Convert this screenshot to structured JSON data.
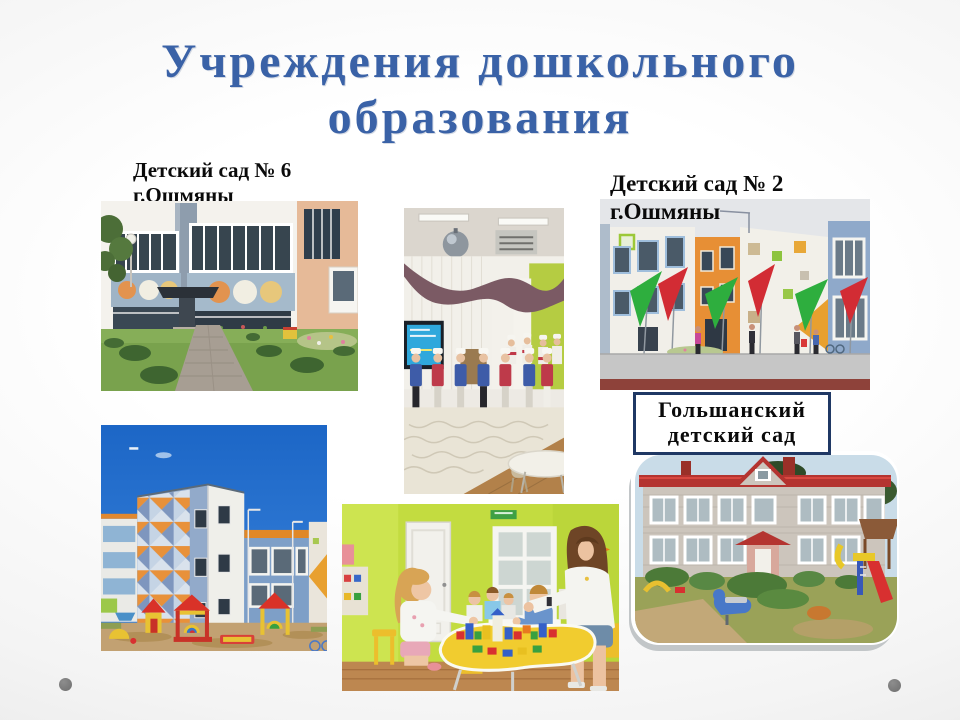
{
  "slide": {
    "title": {
      "line1": "Учреждения дошкольного",
      "line2": "образования"
    },
    "caption_k6": {
      "line1": "Детский сад № 6",
      "line2": "г.Ошмяны"
    },
    "caption_k2": {
      "line1": "Детский сад № 2",
      "line2": "г.Ошмяны"
    },
    "caption_golshany": {
      "line1": "Гольшанский",
      "line2": "детский сад"
    },
    "photos": {
      "k6_building": "Здание детского сада № 6 с дорожкой и газоном",
      "hall_performance": "Дети в костюмах поваров на празднике в зале",
      "k2_building": "Цветное здание детского сада № 2 с флагами",
      "blue_building": "Здание с сине-оранжевым мозаичным фасадом и игровой площадкой",
      "playroom": "Дети играют с кубиками за жёлтым столом с воспитателем",
      "golshany_building": "Здание Гольшанского детского сада с игровой площадкой"
    },
    "colors": {
      "title": "#3A62A7",
      "caption_text": "#0A0A0A",
      "box_border": "#1F3864",
      "dot": "#767676",
      "background_edge": "#DEDEDE"
    }
  }
}
